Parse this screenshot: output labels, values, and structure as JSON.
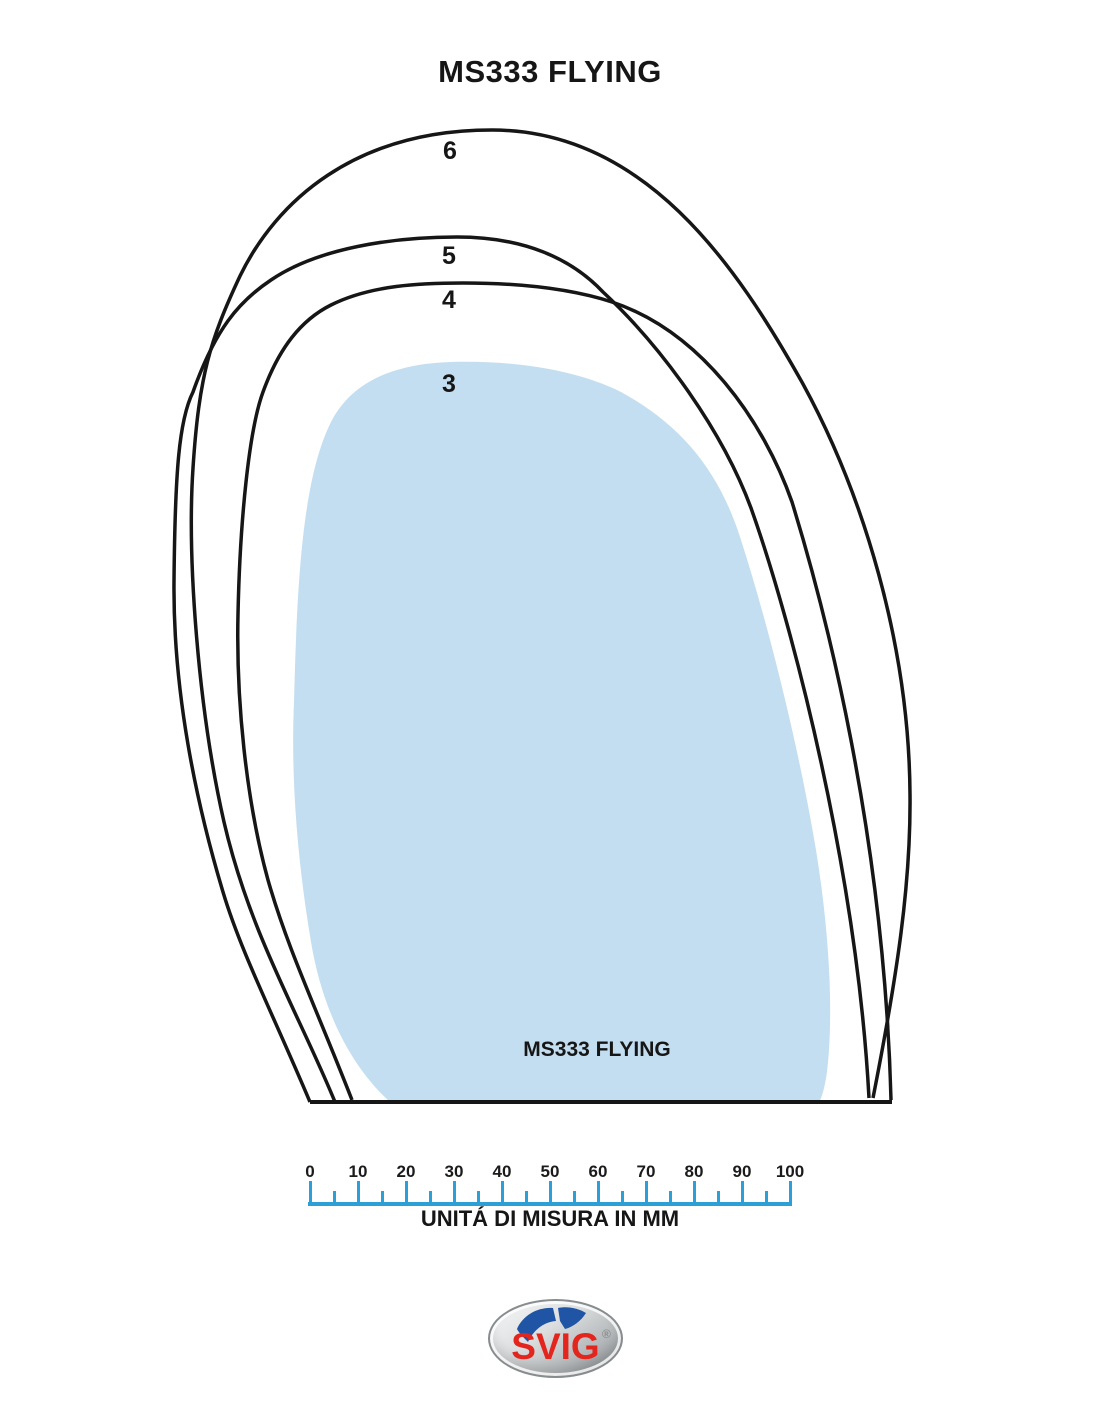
{
  "diagram": {
    "title": "MS333 FLYING",
    "inner_label": "MS333 FLYING",
    "size_labels": [
      "6",
      "5",
      "4",
      "3"
    ],
    "colors": {
      "outline": "#161616",
      "size3_fill": "#c3def0"
    }
  },
  "ruler": {
    "tick_labels": [
      "0",
      "10",
      "20",
      "30",
      "40",
      "50",
      "60",
      "70",
      "80",
      "90",
      "100"
    ],
    "unit_label": "UNITÁ DI MISURA IN MM",
    "color": "#2b9fd6"
  },
  "logo": {
    "brand": "SVIG",
    "registered_mark": "®",
    "text_color": "#e3251d",
    "emblem_color": "#1f55a4"
  }
}
